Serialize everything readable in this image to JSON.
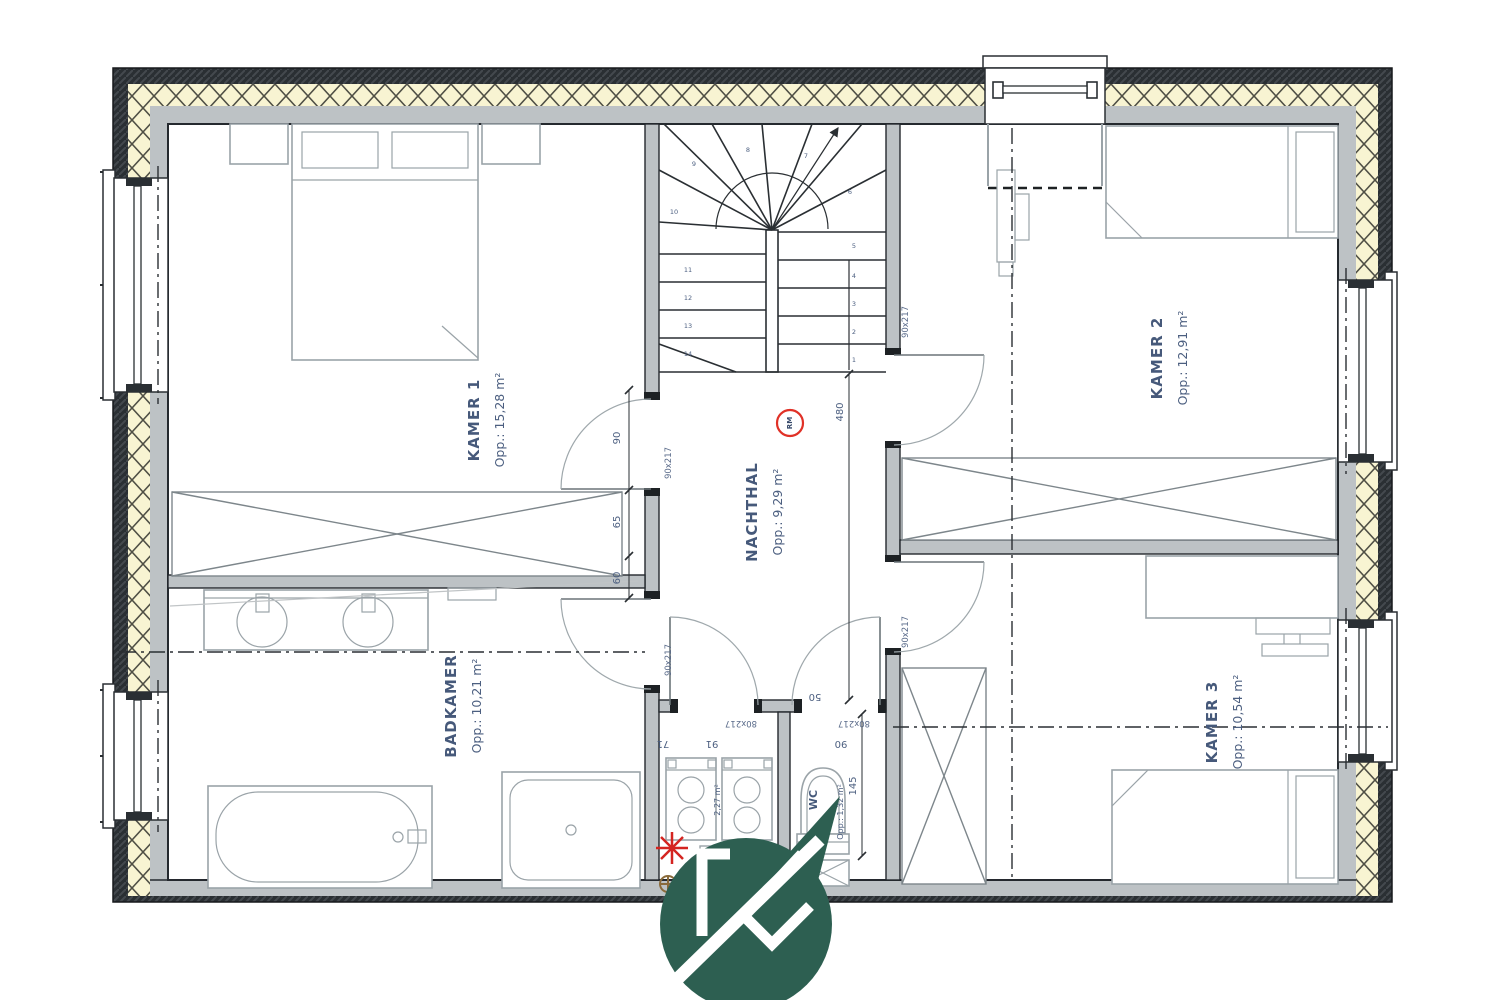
{
  "plan": {
    "rooms": [
      {
        "name": "KAMER 1",
        "area": "Opp.: 15,28 m²"
      },
      {
        "name": "KAMER 2",
        "area": "Opp.: 12,91 m²"
      },
      {
        "name": "KAMER 3",
        "area": "Opp.: 10,54 m²"
      },
      {
        "name": "BADKAMER",
        "area": "Opp.: 10,21 m²"
      },
      {
        "name": "NACHTHAL",
        "area": "Opp.: 9,29 m²"
      },
      {
        "name": "WC",
        "area": "Opp.: 1,32 m²"
      },
      {
        "name": "",
        "area": "2,27 m²"
      }
    ],
    "doors": {
      "standard": "90x217",
      "small": "80x217"
    },
    "dimensions": {
      "door_width": "90",
      "seg65": "65",
      "seg60": "60",
      "hall_length": "480",
      "wc_depth": "145",
      "wc_top": "90",
      "hall_seg": "50",
      "wash_left": "71",
      "wash_right": "91"
    },
    "stair_steps": [
      "1",
      "2",
      "3",
      "4",
      "5",
      "6",
      "7",
      "8",
      "9",
      "10",
      "11",
      "12",
      "13",
      "14"
    ],
    "smoke_detector_label": "RM",
    "logo_letter": "K",
    "colors": {
      "insulation": "#f8f4d2",
      "wall_gray": "#bdc2c5",
      "wall_dark": "#2a2f33",
      "label_blue": "#46597a",
      "dim_blue": "#4c5f80",
      "logo_green": "#2d5f51",
      "detector_red": "#e03127"
    }
  }
}
